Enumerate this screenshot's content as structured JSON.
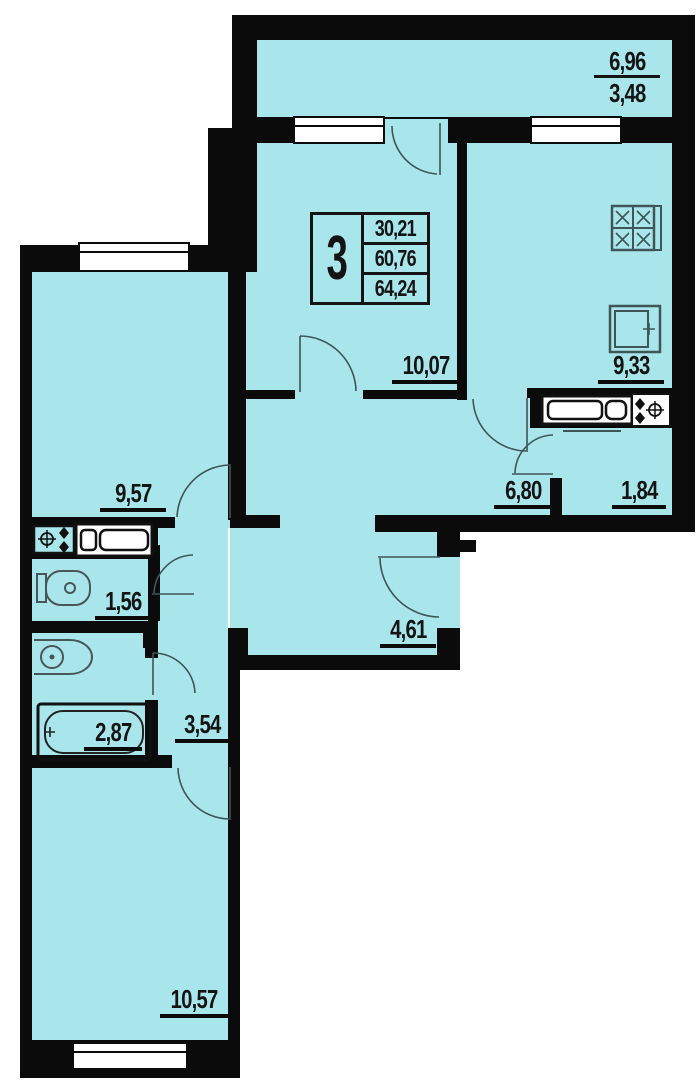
{
  "legend": {
    "rooms_count": "3",
    "area_rows": [
      "30,21",
      "60,76",
      "64,24"
    ]
  },
  "areas": {
    "loggia_top": "6,96",
    "loggia_bottom": "3,48",
    "living": "10,07",
    "kitchen": "9,33",
    "hall": "6,80",
    "storage": "1,84",
    "room_left": "9,57",
    "wc": "1,56",
    "corridor": "4,61",
    "bathroom": "2,87",
    "inner_hall": "3,54",
    "room_bottom": "10,57"
  },
  "colors": {
    "room_fill": "#a9e6ec",
    "wall": "#0b0b0b",
    "fixture_line": "#3f5557",
    "window_fill": "#ffffff"
  }
}
